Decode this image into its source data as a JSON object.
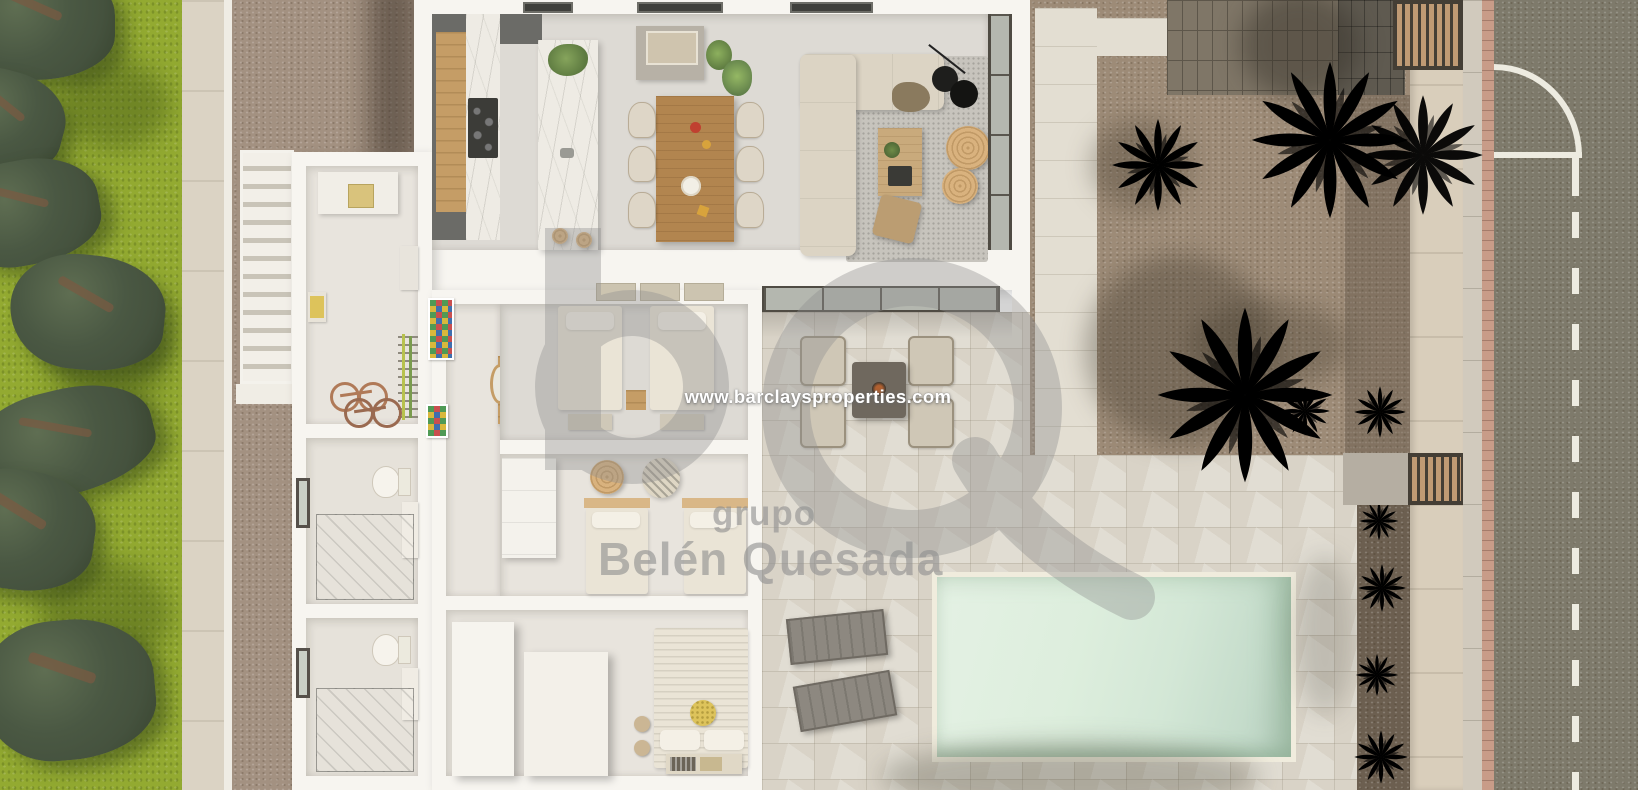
{
  "watermark": {
    "website": "www.barclaysproperties.com",
    "group_label": "grupo",
    "brand_name": "Belén Quesada",
    "monogram": "bQ"
  },
  "palette": {
    "grass": "#93aa31",
    "pine": "#45523e",
    "pine_dark": "#36422d",
    "wall_left": "#dbd3c4",
    "gravel_west": "#a39181",
    "gravel_right": "#9d8b77",
    "gravel_strip": "#6c5f50",
    "house_wall": "#f7f5f0",
    "floor_living": "#dddad4",
    "floor_room": "#e8e4dd",
    "floor_bath": "#e6e2da",
    "kitchen_dark": "#6b6b67",
    "cooktop": "#3c3c38",
    "wood": "#c59d66",
    "wood_dark": "#b2854f",
    "marble": "#eeebe4",
    "chair": "#ded6c7",
    "sofa": "#dcd4c4",
    "rug": "#c7c4bd",
    "glass": "#b4b7af",
    "frame_dark": "#4f4b43",
    "terrace_tile": "#d9d3c7",
    "path": "#e3ded2",
    "pool_rim": "#f0ecdd",
    "pool_light": "#e4f1e4",
    "pool_deep": "#b9d0c1",
    "brick_pad": "#7f7667",
    "brick_line": "#5d564a",
    "apron": "#5f5a50",
    "road": "#7e7a6b",
    "marking": "#edebe0",
    "sidewalk": "#d1cabd",
    "brick_edge": "#c89c88",
    "wall_right": "#d9cebb",
    "gate_dark": "#443e35",
    "gate_wood": "#bf9a74",
    "bed": "#eae4d6",
    "pillow": "#f4f0e6",
    "bed_trim": "#d9b787",
    "yellow": "#ddc35b",
    "lounger": "#8d8880",
    "palm": "#7c9751",
    "palm_dark": "#5d7540",
    "shrub": "#4d6836",
    "watermark_gray": "#8f8f8f",
    "watermark_text": "#ffffff"
  }
}
